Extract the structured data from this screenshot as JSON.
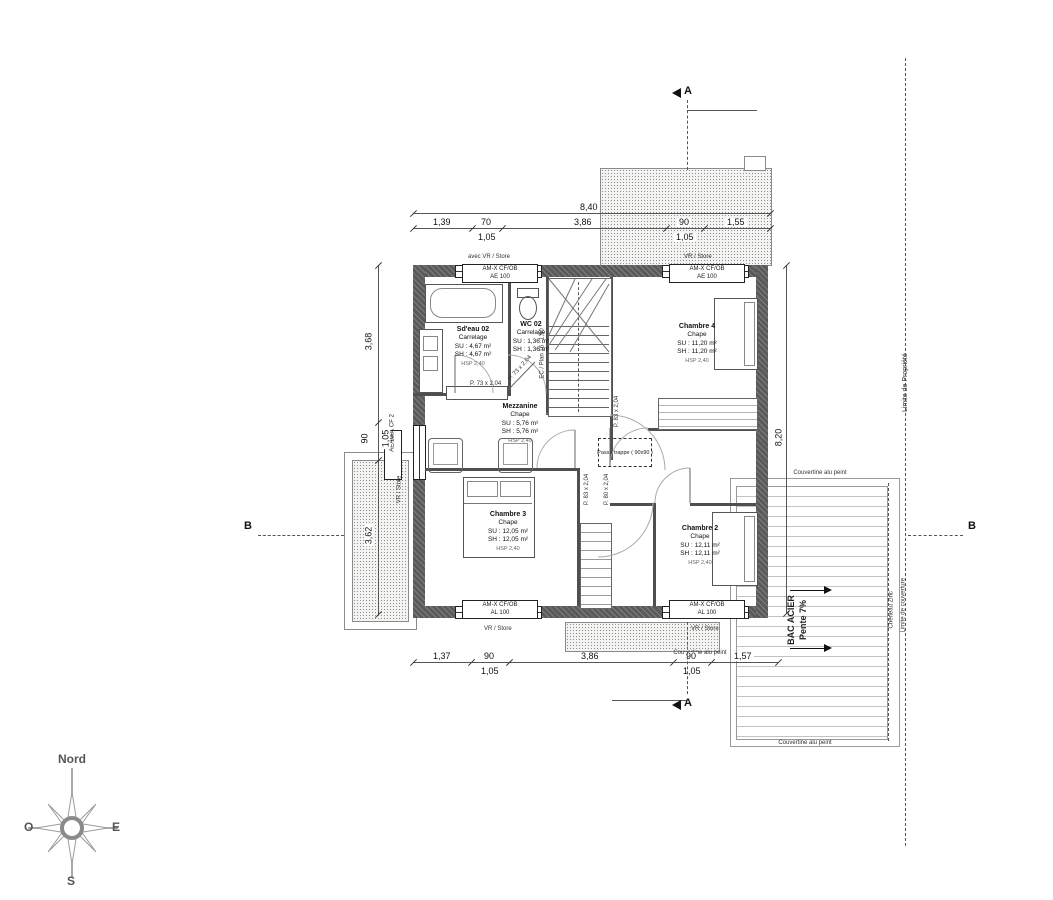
{
  "compass": {
    "north": "Nord",
    "west": "O",
    "east": "E",
    "south": "S"
  },
  "markers": {
    "section_a": "A",
    "section_b": "B"
  },
  "property_line": {
    "label": "Limite de Propriété"
  },
  "dimensions": {
    "top_total": "8,40",
    "top": [
      "1,39",
      "70",
      "3,86",
      "90",
      "1,55"
    ],
    "top_sub_left": "1,05",
    "top_sub_right": "1,05",
    "bottom": [
      "1,37",
      "90",
      "3,86",
      "90",
      "1,57"
    ],
    "bottom_sub_left": "1,05",
    "bottom_sub_right": "1,05",
    "left_top": "3,68",
    "left_mid": "90",
    "left_mid_sub": "1,05",
    "left_bottom": "3,62",
    "right_total": "8,20"
  },
  "rooms": [
    {
      "name": "Sd'eau 02",
      "finish": "Carrelage",
      "su": "SU : 4,67 m²",
      "sh": "SH : 4,67 m²",
      "note": "HSP 2,40"
    },
    {
      "name": "WC 02",
      "finish": "Carrelage",
      "su": "SU : 1,36 m²",
      "sh": "SH : 1,36 m²",
      "note": ""
    },
    {
      "name": "Chambre 4",
      "finish": "Chape",
      "su": "SU : 11,20 m²",
      "sh": "SH : 11,20 m²",
      "note": "HSP 2,40"
    },
    {
      "name": "Mezzanine",
      "finish": "Chape",
      "su": "SU : 5,76 m²",
      "sh": "SH : 5,76 m²",
      "note": "HSP 2,40"
    },
    {
      "name": "Chambre 3",
      "finish": "Chape",
      "su": "SU : 12,05 m²",
      "sh": "SH : 12,05 m²",
      "note": "HSP 2,40"
    },
    {
      "name": "Chambre 2",
      "finish": "Chape",
      "su": "SU : 12,11 m²",
      "sh": "SH : 12,11 m²",
      "note": "HSP 2,40"
    }
  ],
  "windows": {
    "top_left": {
      "line1": "AM-X CF/OB",
      "line2": "AE 100",
      "note": "avec VR / Store"
    },
    "top_right": {
      "line1": "AM-X CF/OB",
      "line2": "AE 100",
      "note": "VR / Store"
    },
    "bottom_left": {
      "line1": "AM-X CF/OB",
      "line2": "AL 100",
      "note": "VR / Store"
    },
    "bottom_right": {
      "line1": "AM-X CF/OB",
      "line2": "AL 100",
      "note": "VR / Store"
    },
    "left": {
      "line1": "AM-X CF 2",
      "line2": "AE 100",
      "note": "VR / Store"
    }
  },
  "doors": {
    "wc": "P. 73 x 2,04",
    "sdeau": "P. 73 x 2,04",
    "hall_right": "P. 83 x 2,04",
    "hall_left": "P. 83 x 2,04",
    "hall_mid": "P. 80 x 2,04"
  },
  "stair": {
    "label": "EC / Plan 16 : 1,90"
  },
  "trap": {
    "label": "Passe trappe ( 90x90 )"
  },
  "terrace": {
    "material": "BAC ACIER",
    "slope": "Pente 7%",
    "edge_top": "Couvertine alu peint",
    "edge_bottom": "Couvertine alu peint",
    "edge_small": "Couvertine alu peint",
    "gutter": "Cheneau Zinc",
    "cover_limit": "Limite de couverture"
  }
}
